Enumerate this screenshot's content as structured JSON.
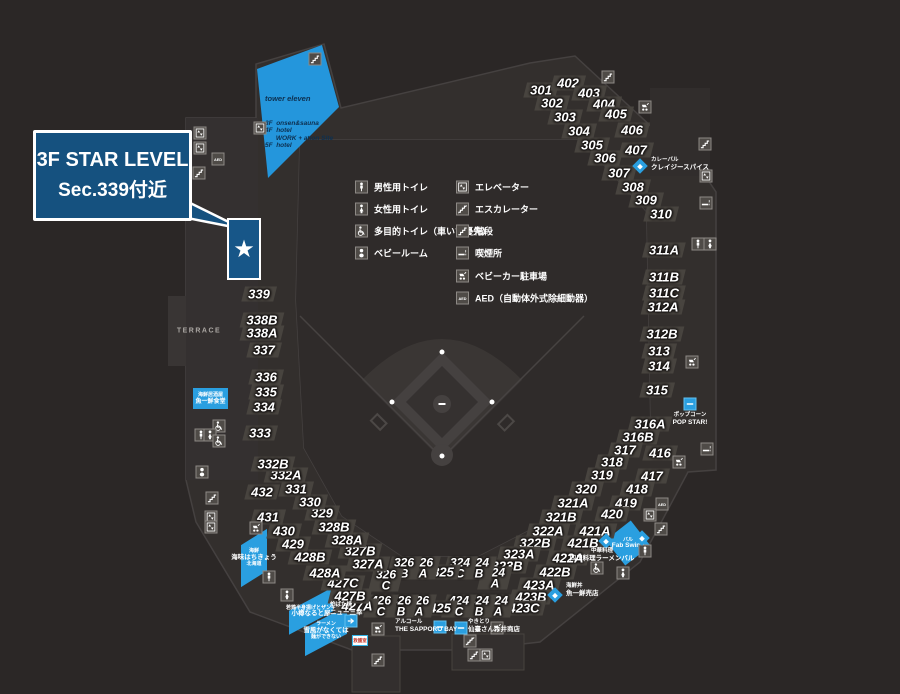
{
  "colors": {
    "background": "#2b2726",
    "concourse": "#332f2d",
    "chip": "#48443f",
    "accent_blue": "#2a9fe0",
    "tower_blue": "#2496dc",
    "deep_blue": "#15517f",
    "star_box_blue": "#175688",
    "white": "#ffffff"
  },
  "callout": {
    "line1": "3F STAR LEVEL",
    "line2": "Sec.339付近"
  },
  "star_marker": "★",
  "tower": {
    "title": "tower eleven",
    "floors": [
      "3F  onsen&sauna",
      "4F  hotel",
      "      WORK + ation Site",
      "5F  hotel"
    ]
  },
  "terrace": "TERRACE",
  "misc": {
    "first_aid": "救護室"
  },
  "legend": {
    "left": [
      {
        "icon": "man",
        "label": "男性用トイレ"
      },
      {
        "icon": "woman",
        "label": "女性用トイレ"
      },
      {
        "icon": "wheelchair",
        "label": "多目的トイレ（車いす優先）"
      },
      {
        "icon": "baby",
        "label": "ベビールーム"
      }
    ],
    "right": [
      {
        "icon": "elevator",
        "label": "エレベーター"
      },
      {
        "icon": "escalator",
        "label": "エスカレーター"
      },
      {
        "icon": "stairs",
        "label": "階段"
      },
      {
        "icon": "smoking",
        "label": "喫煙所"
      },
      {
        "icon": "stroller",
        "label": "ベビーカー駐車場"
      },
      {
        "icon": "aed",
        "label": "AED（自動体外式除細動器）"
      }
    ],
    "left_pos": {
      "icon_x": 355,
      "label_x": 374,
      "rows_y": [
        187,
        209,
        231,
        253
      ]
    },
    "right_pos": {
      "icon_x": 456,
      "label_x": 475,
      "rows_y": [
        187,
        209,
        231,
        253,
        276,
        298
      ]
    }
  },
  "sections": [
    {
      "label": "301",
      "x": 541,
      "y": 90
    },
    {
      "label": "302",
      "x": 552,
      "y": 103
    },
    {
      "label": "303",
      "x": 565,
      "y": 117
    },
    {
      "label": "304",
      "x": 579,
      "y": 131
    },
    {
      "label": "305",
      "x": 592,
      "y": 145
    },
    {
      "label": "306",
      "x": 605,
      "y": 158
    },
    {
      "label": "307",
      "x": 619,
      "y": 173
    },
    {
      "label": "308",
      "x": 633,
      "y": 187
    },
    {
      "label": "309",
      "x": 646,
      "y": 200
    },
    {
      "label": "310",
      "x": 661,
      "y": 214
    },
    {
      "label": "402",
      "x": 568,
      "y": 83
    },
    {
      "label": "403",
      "x": 589,
      "y": 93
    },
    {
      "label": "404",
      "x": 604,
      "y": 104
    },
    {
      "label": "405",
      "x": 616,
      "y": 114
    },
    {
      "label": "406",
      "x": 632,
      "y": 130
    },
    {
      "label": "407",
      "x": 636,
      "y": 150
    },
    {
      "label": "311A",
      "x": 664,
      "y": 250
    },
    {
      "label": "311B",
      "x": 664,
      "y": 277
    },
    {
      "label": "311C",
      "x": 664,
      "y": 293
    },
    {
      "label": "312A",
      "x": 663,
      "y": 307
    },
    {
      "label": "312B",
      "x": 662,
      "y": 334
    },
    {
      "label": "313",
      "x": 659,
      "y": 351
    },
    {
      "label": "314",
      "x": 659,
      "y": 366
    },
    {
      "label": "315",
      "x": 657,
      "y": 390
    },
    {
      "label": "316A",
      "x": 650,
      "y": 424
    },
    {
      "label": "316B",
      "x": 638,
      "y": 437
    },
    {
      "label": "317",
      "x": 625,
      "y": 450
    },
    {
      "label": "318",
      "x": 612,
      "y": 462
    },
    {
      "label": "319",
      "x": 602,
      "y": 475
    },
    {
      "label": "320",
      "x": 586,
      "y": 489
    },
    {
      "label": "321A",
      "x": 573,
      "y": 503
    },
    {
      "label": "321B",
      "x": 561,
      "y": 517
    },
    {
      "label": "322A",
      "x": 548,
      "y": 531
    },
    {
      "label": "322B",
      "x": 535,
      "y": 543
    },
    {
      "label": "323A",
      "x": 519,
      "y": 554
    },
    {
      "label": "323B",
      "x": 507,
      "y": 566
    },
    {
      "label": "324A",
      "x": 495,
      "y": 578,
      "stack": true
    },
    {
      "label": "324B",
      "x": 479,
      "y": 568,
      "stack": true
    },
    {
      "label": "324C",
      "x": 460,
      "y": 568,
      "stack": true
    },
    {
      "label": "325",
      "x": 443,
      "y": 572
    },
    {
      "label": "326A",
      "x": 423,
      "y": 568,
      "stack": true
    },
    {
      "label": "326B",
      "x": 404,
      "y": 568,
      "stack": true
    },
    {
      "label": "326C",
      "x": 386,
      "y": 580,
      "stack": true
    },
    {
      "label": "327A",
      "x": 368,
      "y": 564
    },
    {
      "label": "327B",
      "x": 360,
      "y": 551
    },
    {
      "label": "328A",
      "x": 347,
      "y": 540
    },
    {
      "label": "328B",
      "x": 334,
      "y": 527
    },
    {
      "label": "329",
      "x": 322,
      "y": 513
    },
    {
      "label": "330",
      "x": 310,
      "y": 502
    },
    {
      "label": "331",
      "x": 296,
      "y": 489
    },
    {
      "label": "332A",
      "x": 286,
      "y": 475
    },
    {
      "label": "332B",
      "x": 273,
      "y": 464
    },
    {
      "label": "333",
      "x": 260,
      "y": 433
    },
    {
      "label": "334",
      "x": 264,
      "y": 407
    },
    {
      "label": "335",
      "x": 266,
      "y": 392
    },
    {
      "label": "336",
      "x": 266,
      "y": 377
    },
    {
      "label": "337",
      "x": 264,
      "y": 350
    },
    {
      "label": "338A",
      "x": 262,
      "y": 333
    },
    {
      "label": "338B",
      "x": 262,
      "y": 320
    },
    {
      "label": "339",
      "x": 259,
      "y": 294
    },
    {
      "label": "416",
      "x": 660,
      "y": 453
    },
    {
      "label": "417",
      "x": 652,
      "y": 476
    },
    {
      "label": "418",
      "x": 637,
      "y": 489
    },
    {
      "label": "419",
      "x": 626,
      "y": 503
    },
    {
      "label": "420",
      "x": 612,
      "y": 514
    },
    {
      "label": "421A",
      "x": 595,
      "y": 531
    },
    {
      "label": "421B",
      "x": 583,
      "y": 543
    },
    {
      "label": "422A",
      "x": 568,
      "y": 558
    },
    {
      "label": "422B",
      "x": 555,
      "y": 572
    },
    {
      "label": "423A",
      "x": 539,
      "y": 585
    },
    {
      "label": "423B",
      "x": 531,
      "y": 597
    },
    {
      "label": "423C",
      "x": 524,
      "y": 608
    },
    {
      "label": "424A",
      "x": 498,
      "y": 606,
      "stack": true
    },
    {
      "label": "424B",
      "x": 479,
      "y": 606,
      "stack": true
    },
    {
      "label": "424C",
      "x": 459,
      "y": 606,
      "stack": true
    },
    {
      "label": "425",
      "x": 440,
      "y": 608
    },
    {
      "label": "426A",
      "x": 419,
      "y": 606,
      "stack": true
    },
    {
      "label": "426B",
      "x": 401,
      "y": 606,
      "stack": true
    },
    {
      "label": "426C",
      "x": 381,
      "y": 606,
      "stack": true
    },
    {
      "label": "427A",
      "x": 357,
      "y": 606
    },
    {
      "label": "427B",
      "x": 350,
      "y": 596
    },
    {
      "label": "427C",
      "x": 343,
      "y": 583
    },
    {
      "label": "428A",
      "x": 325,
      "y": 573
    },
    {
      "label": "428B",
      "x": 310,
      "y": 557
    },
    {
      "label": "429",
      "x": 293,
      "y": 544
    },
    {
      "label": "430",
      "x": 284,
      "y": 531
    },
    {
      "label": "431",
      "x": 268,
      "y": 517
    },
    {
      "label": "432",
      "x": 262,
      "y": 492
    }
  ],
  "icons": [
    {
      "kind": "stairs",
      "x": 315,
      "y": 59
    },
    {
      "kind": "elevator",
      "x": 260,
      "y": 128
    },
    {
      "kind": "elevator",
      "x": 200,
      "y": 133
    },
    {
      "kind": "elevator",
      "x": 200,
      "y": 148
    },
    {
      "kind": "aed",
      "x": 218,
      "y": 159
    },
    {
      "kind": "stairs",
      "x": 199,
      "y": 173
    },
    {
      "kind": "stairs",
      "x": 608,
      "y": 77
    },
    {
      "kind": "stroller",
      "x": 645,
      "y": 107
    },
    {
      "kind": "stairs",
      "x": 705,
      "y": 144
    },
    {
      "kind": "elevator",
      "x": 706,
      "y": 176
    },
    {
      "kind": "smoking",
      "x": 706,
      "y": 203
    },
    {
      "kind": "man",
      "x": 698,
      "y": 244
    },
    {
      "kind": "woman",
      "x": 710,
      "y": 244
    },
    {
      "kind": "stroller",
      "x": 692,
      "y": 362
    },
    {
      "kind": "smoking",
      "x": 707,
      "y": 449
    },
    {
      "kind": "stroller",
      "x": 679,
      "y": 462
    },
    {
      "kind": "aed",
      "x": 662,
      "y": 504
    },
    {
      "kind": "elevator",
      "x": 650,
      "y": 515
    },
    {
      "kind": "stairs",
      "x": 661,
      "y": 529
    },
    {
      "kind": "man",
      "x": 645,
      "y": 551
    },
    {
      "kind": "wheelchair",
      "x": 597,
      "y": 568
    },
    {
      "kind": "woman",
      "x": 623,
      "y": 573
    },
    {
      "kind": "wheelchair",
      "x": 219,
      "y": 426
    },
    {
      "kind": "man",
      "x": 201,
      "y": 435
    },
    {
      "kind": "woman",
      "x": 210,
      "y": 435
    },
    {
      "kind": "wheelchair",
      "x": 219,
      "y": 441
    },
    {
      "kind": "baby",
      "x": 202,
      "y": 472
    },
    {
      "kind": "stairs",
      "x": 212,
      "y": 498
    },
    {
      "kind": "elevator",
      "x": 211,
      "y": 517
    },
    {
      "kind": "elevator",
      "x": 211,
      "y": 527
    },
    {
      "kind": "stroller",
      "x": 256,
      "y": 528
    },
    {
      "kind": "man",
      "x": 269,
      "y": 577
    },
    {
      "kind": "woman",
      "x": 287,
      "y": 595
    },
    {
      "kind": "arrow",
      "x": 351,
      "y": 621
    },
    {
      "kind": "stroller",
      "x": 378,
      "y": 629
    },
    {
      "kind": "stairs",
      "x": 378,
      "y": 660
    },
    {
      "kind": "shopbox",
      "x": 440,
      "y": 627
    },
    {
      "kind": "shopbox",
      "x": 461,
      "y": 628
    },
    {
      "kind": "stroller",
      "x": 497,
      "y": 628
    },
    {
      "kind": "escalator",
      "x": 470,
      "y": 641
    },
    {
      "kind": "stairs",
      "x": 474,
      "y": 655
    },
    {
      "kind": "elevator",
      "x": 486,
      "y": 655
    }
  ],
  "shops": [
    {
      "type": "diamond",
      "x": 640,
      "y": 166,
      "lines": [
        "カレーバル",
        "クレイジースパイス"
      ],
      "lx": 651,
      "ly": 157,
      "align": "left"
    },
    {
      "type": "box",
      "x": 690,
      "y": 404,
      "lines": [
        "ポップコーン",
        "POP STAR!"
      ],
      "lx": 690,
      "ly": 412,
      "align": "center"
    },
    {
      "type": "para",
      "x": 628,
      "y": 543,
      "w": 32,
      "h": 32,
      "rot": -38,
      "lines": [
        "バル",
        "Fab Swing"
      ],
      "big": 1
    },
    {
      "type": "diamond",
      "x": 606,
      "y": 541,
      "lines": [
        "中華料理",
        "四川料理ラーメンバル"
      ],
      "lx": 602,
      "ly": 548,
      "align": "center"
    },
    {
      "type": "diamond",
      "x": 555,
      "y": 595,
      "lines": [
        "海鮮丼",
        "魚一鮮売店"
      ],
      "lx": 566,
      "ly": 583,
      "align": "left"
    },
    {
      "type": "label",
      "lines": [
        "アルコール",
        "THE SAPPORO BAY"
      ],
      "lx": 395,
      "ly": 619,
      "align": "left"
    },
    {
      "type": "label",
      "lines": [
        "やきとり",
        "仙臺さん今井商店"
      ],
      "lx": 468,
      "ly": 619,
      "align": "left"
    },
    {
      "type": "para",
      "x": 254,
      "y": 558,
      "w": 26,
      "h": 42,
      "skewY": -32,
      "lines": [
        "海鮮",
        "海味はちきょう",
        "北海道"
      ],
      "big": 1
    },
    {
      "type": "para",
      "x": 311,
      "y": 611,
      "w": 44,
      "h": 24,
      "skewY": -28,
      "lines": [
        "若鶏半身揚げとザンギ",
        "小樽なると屋"
      ],
      "big": 1
    },
    {
      "type": "label",
      "lines": [
        "炉ばた焼",
        "ニュー三幸"
      ],
      "lx": 330,
      "ly": 602,
      "align": "left"
    },
    {
      "type": "para",
      "x": 326,
      "y": 631,
      "w": 42,
      "h": 28,
      "skewY": -28,
      "lines": [
        "ラーメン",
        "雪風がなくては",
        "麺ができない"
      ],
      "big": 1
    },
    {
      "type": "bluebox",
      "x": 193,
      "y": 388,
      "w": 35,
      "h": 21,
      "lines": [
        "海鮮居酒屋",
        "魚一鮮食堂"
      ],
      "big": 1
    },
    {
      "type": "diamond",
      "x": 642,
      "y": 538,
      "lines": []
    }
  ]
}
